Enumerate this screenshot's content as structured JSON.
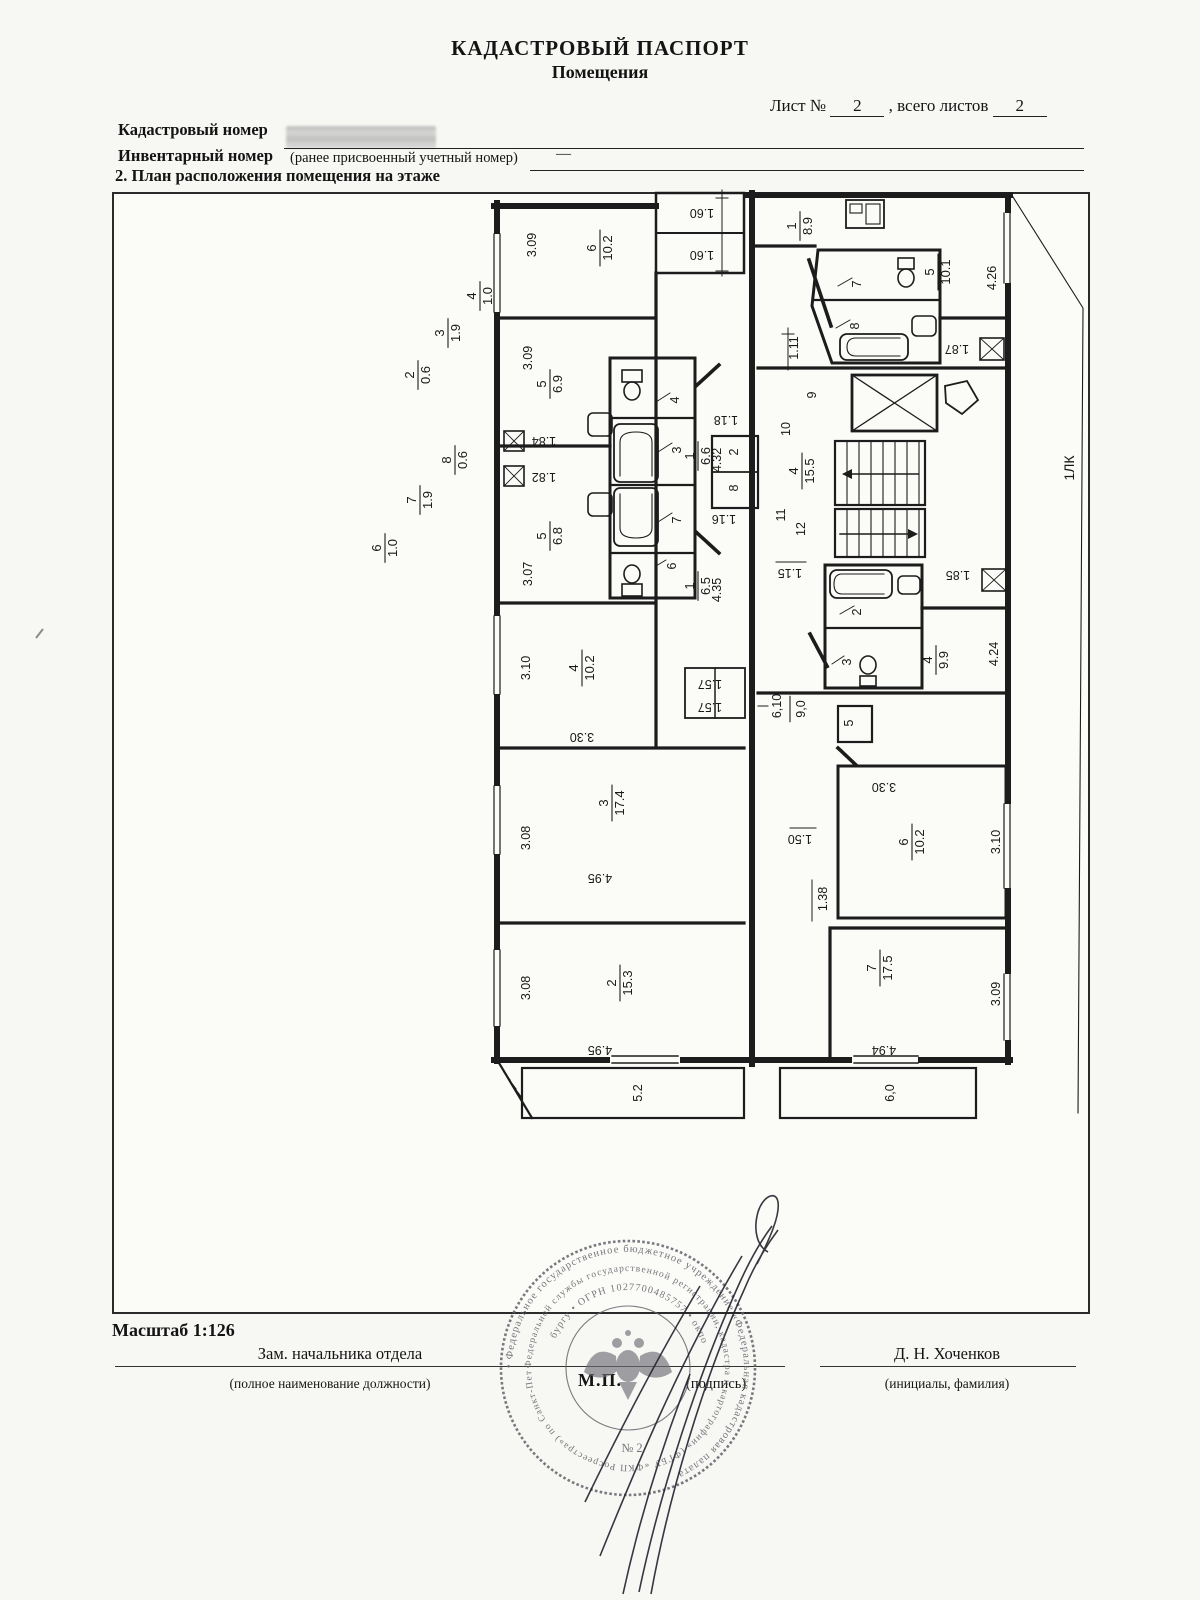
{
  "header": {
    "title": "КАДАСТРОВЫЙ ПАСПОРТ",
    "subtitle": "Помещения",
    "sheet_label": "Лист №",
    "sheet_value": "2",
    "total_label": ", всего листов",
    "total_value": "2"
  },
  "fields": {
    "cadastral_label": "Кадастровый номер",
    "inventory_label": "Инвентарный номер",
    "inventory_note": "(ранее присвоенный учетный номер)",
    "inventory_value": "—",
    "section_title": "2. План расположения помещения на этаже"
  },
  "footer": {
    "scale": "Масштаб 1:126",
    "position_title": "Зам. начальника отдела",
    "position_note": "(полное наименование должности)",
    "mp": "М.П.",
    "signature_note": "(подпись)",
    "name": "Д. Н. Хоченков",
    "name_note": "(инициалы, фамилия)"
  },
  "stamp": {
    "rings": [
      "• Федеральное государственное бюджетное учреждение «Федеральная кадастровая палата",
      "Федеральной службы государственной регистрации, кадастра и картографии» (ФГБУ «ФКП Росреестра») по Санкт-Петер",
      "бургу • ОГРН 1027700485757 • окпо"
    ],
    "center_mark": "№ 2"
  },
  "plan": {
    "labels": [
      {
        "n": "4",
        "d": "1.0",
        "x": 120,
        "y": 108
      },
      {
        "n": "3",
        "d": "1.9",
        "x": 88,
        "y": 145
      },
      {
        "n": "2",
        "d": "0.6",
        "x": 58,
        "y": 187
      },
      {
        "n": "8",
        "d": "0.6",
        "x": 95,
        "y": 272
      },
      {
        "n": "7",
        "d": "1.9",
        "x": 60,
        "y": 312
      },
      {
        "n": "6",
        "d": "1.0",
        "x": 25,
        "y": 360
      },
      {
        "t": "3.09",
        "x": 172,
        "y": 57
      },
      {
        "n": "6",
        "d": "10.2",
        "x": 240,
        "y": 60
      },
      {
        "t": "1.60",
        "x": 342,
        "y": 25,
        "r": 180
      },
      {
        "t": "1.60",
        "x": 342,
        "y": 67,
        "r": 180
      },
      {
        "t": "3.09",
        "x": 168,
        "y": 170
      },
      {
        "n": "5",
        "d": "6.9",
        "x": 190,
        "y": 196
      },
      {
        "n": "1",
        "d": "6.6",
        "x": 338,
        "y": 268
      },
      {
        "t": "4.32",
        "x": 357,
        "y": 272
      },
      {
        "t": "4",
        "x": 315,
        "y": 212
      },
      {
        "t": "3",
        "x": 317,
        "y": 262
      },
      {
        "t": "1.84",
        "x": 184,
        "y": 253,
        "r": 180
      },
      {
        "t": "1.82",
        "x": 184,
        "y": 289,
        "r": 180
      },
      {
        "t": "2",
        "x": 374,
        "y": 264
      },
      {
        "t": "8",
        "x": 374,
        "y": 300
      },
      {
        "t": "1.18",
        "x": 366,
        "y": 232,
        "r": 180
      },
      {
        "t": "1.16",
        "x": 364,
        "y": 331,
        "r": 180
      },
      {
        "t": "7",
        "x": 317,
        "y": 332
      },
      {
        "t": "6",
        "x": 312,
        "y": 378
      },
      {
        "n": "5",
        "d": "6.8",
        "x": 190,
        "y": 348
      },
      {
        "t": "3.07",
        "x": 168,
        "y": 386
      },
      {
        "n": "1",
        "d": "6.5",
        "x": 338,
        "y": 398
      },
      {
        "t": "4.35",
        "x": 357,
        "y": 402
      },
      {
        "n": "4",
        "d": "10.2",
        "x": 222,
        "y": 480
      },
      {
        "t": "3.10",
        "x": 166,
        "y": 480
      },
      {
        "t": "3.30",
        "x": 222,
        "y": 549,
        "r": 180
      },
      {
        "t": "1.57",
        "x": 350,
        "y": 496,
        "r": 180
      },
      {
        "t": "1.57",
        "x": 350,
        "y": 519,
        "r": 180
      },
      {
        "n": "3",
        "d": "17.4",
        "x": 252,
        "y": 615
      },
      {
        "t": "3.08",
        "x": 166,
        "y": 650
      },
      {
        "t": "4.95",
        "x": 240,
        "y": 690,
        "r": 180
      },
      {
        "n": "2",
        "d": "15.3",
        "x": 260,
        "y": 795
      },
      {
        "t": "3.08",
        "x": 166,
        "y": 800
      },
      {
        "t": "4.95",
        "x": 240,
        "y": 862,
        "r": 180
      },
      {
        "t": "5.2",
        "x": 278,
        "y": 905
      },
      {
        "n": "1",
        "d": "8.9",
        "x": 440,
        "y": 38
      },
      {
        "n": "5",
        "d": "10.1",
        "x": 578,
        "y": 84
      },
      {
        "t": "4.26",
        "x": 632,
        "y": 90
      },
      {
        "t": "7",
        "x": 497,
        "y": 96
      },
      {
        "t": "8",
        "x": 495,
        "y": 138
      },
      {
        "t": "1.87",
        "x": 597,
        "y": 161,
        "r": 180
      },
      {
        "t": "1.11",
        "x": 434,
        "y": 160
      },
      {
        "t": "9",
        "x": 452,
        "y": 207
      },
      {
        "t": "10",
        "x": 426,
        "y": 241
      },
      {
        "n": "4",
        "d": "15.5",
        "x": 442,
        "y": 283
      },
      {
        "t": "11",
        "x": 421,
        "y": 327
      },
      {
        "t": "12",
        "x": 441,
        "y": 341
      },
      {
        "t": "1.15",
        "x": 430,
        "y": 385,
        "r": 180
      },
      {
        "t": "1.85",
        "x": 598,
        "y": 387,
        "r": 180
      },
      {
        "t": "2",
        "x": 497,
        "y": 424
      },
      {
        "t": "3",
        "x": 487,
        "y": 474
      },
      {
        "n": "4",
        "d": "9.9",
        "x": 576,
        "y": 472
      },
      {
        "t": "4.24",
        "x": 634,
        "y": 466
      },
      {
        "t": "6,10",
        "x": 417,
        "y": 518
      },
      {
        "t": "9,0",
        "x": 441,
        "y": 521,
        "bar": true
      },
      {
        "t": "5",
        "x": 489,
        "y": 535
      },
      {
        "t": "3.30",
        "x": 524,
        "y": 599,
        "r": 180
      },
      {
        "n": "6",
        "d": "10.2",
        "x": 552,
        "y": 654
      },
      {
        "t": "3.10",
        "x": 636,
        "y": 654
      },
      {
        "t": "1.50",
        "x": 440,
        "y": 651,
        "r": 180
      },
      {
        "t": "1.38",
        "x": 463,
        "y": 711
      },
      {
        "n": "7",
        "d": "17.5",
        "x": 520,
        "y": 780
      },
      {
        "t": "3.09",
        "x": 636,
        "y": 806
      },
      {
        "t": "4.94",
        "x": 524,
        "y": 862,
        "r": 180
      },
      {
        "t": "6,0",
        "x": 530,
        "y": 905
      },
      {
        "t": "1ЛК",
        "x": 710,
        "y": 280,
        "s": 14
      }
    ]
  }
}
